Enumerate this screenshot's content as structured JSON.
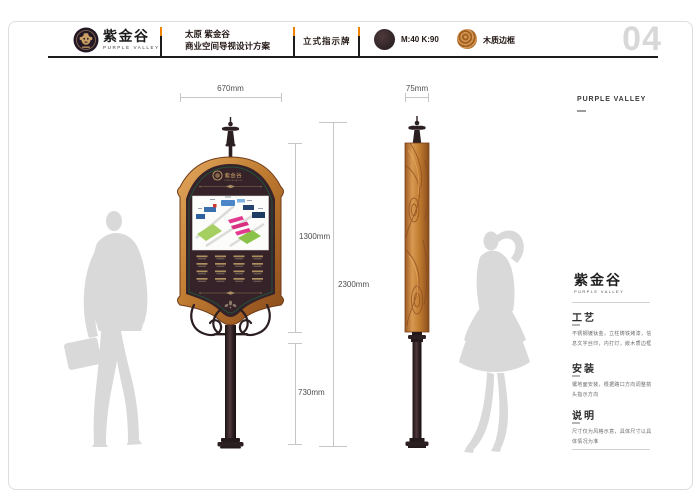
{
  "page": {
    "number": "04"
  },
  "header": {
    "brand": {
      "cn": "紫金谷",
      "en": "PURPLE VALLEY"
    },
    "project": {
      "line1": "太原 紫金谷",
      "line2": "商业空间导视设计方案"
    },
    "sheet_title": "立式指示牌",
    "swatches": [
      {
        "label": "M:40 K:90",
        "color": "#35282a",
        "type": "paint-swatch"
      },
      {
        "label": "木质边框",
        "color": "#c08440",
        "type": "wood-swatch"
      }
    ]
  },
  "dimensions": {
    "front_width": "670mm",
    "panel_height": "1300mm",
    "total_height": "2300mm",
    "pole_height": "730mm",
    "side_width": "75mm"
  },
  "sign": {
    "logo_cn": "紫金谷",
    "logo_en": "PURPLE VALLEY"
  },
  "info": {
    "brand_en": "PURPLE VALLEY",
    "logo_cn": "紫金谷",
    "logo_en": "PURPLE VALLEY",
    "sections": [
      {
        "title": "工艺",
        "body": "不锈钢镀钛金，立柱铸铁烤漆，信息文字丝印，内打灯，嵌木质边框"
      },
      {
        "title": "安装",
        "body": "镶地面安装，根据路口方向调整箭头指示方向"
      },
      {
        "title": "说明",
        "body": "尺寸仅为风格示意，具体尺寸以具体情况为准"
      }
    ]
  },
  "colors": {
    "accent_orange": "#ef8200",
    "panel_dark": "#352329",
    "trim_green": "#23523b",
    "gold": "#c9a063",
    "wood": "#c08440",
    "silhouette": "#d9d9d9"
  }
}
